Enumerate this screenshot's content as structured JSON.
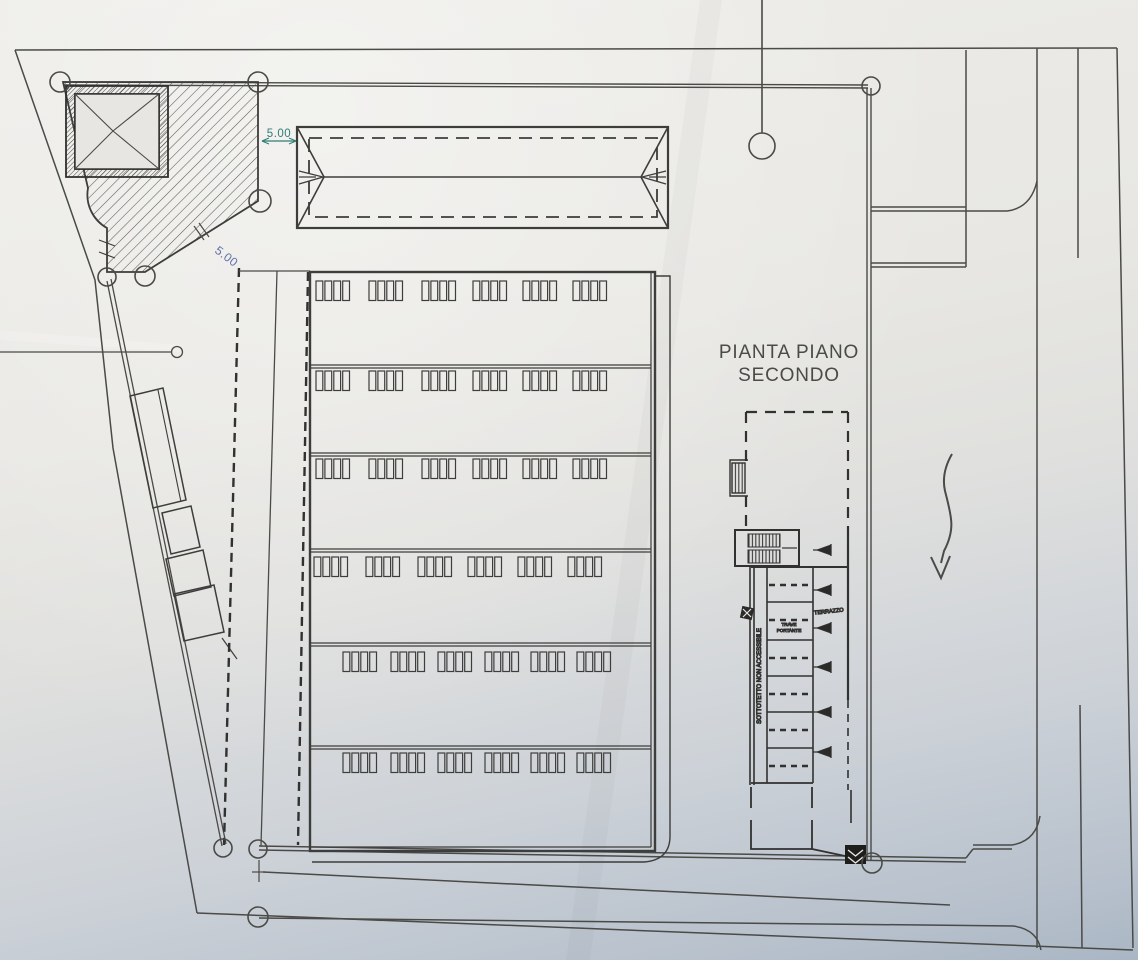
{
  "drawing": {
    "title": {
      "line1": "PIANTA PIANO",
      "line2": "SECONDO"
    },
    "labels": {
      "terrace": "TERRAZZO",
      "attic_corridor": "SOTTOTETTO NON ACCESSIBILE",
      "beam_line1": "TRAVE",
      "beam_line2": "PORTANTE"
    },
    "dimensions": {
      "top_offset": "5.00",
      "diagonal_offset": "5.00"
    },
    "colors": {
      "ink": "#4a4a47",
      "heavy_dash": "#31312f",
      "dimension_teal": "#2f7d74",
      "dimension_blue": "#5f6fa8",
      "paper_light": "#edece8",
      "paper_dark": "#aab6c4"
    },
    "building": {
      "window_rows": 6,
      "window_groups_per_row": 6,
      "panes_per_group": 4
    }
  }
}
